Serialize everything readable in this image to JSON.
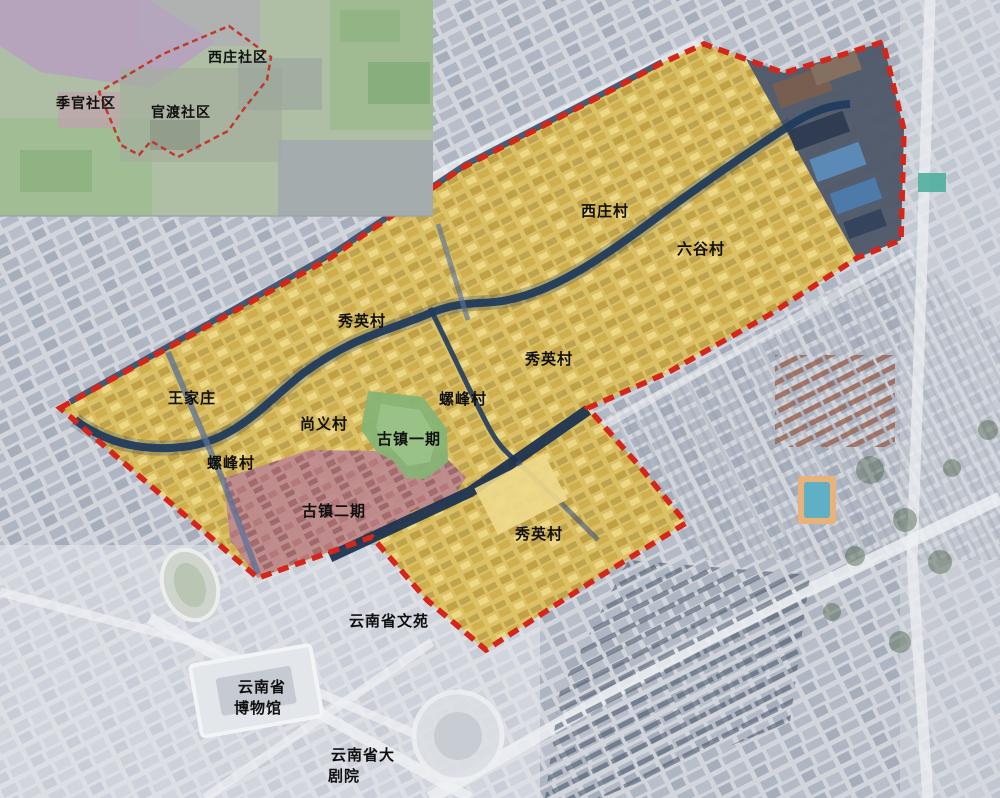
{
  "figure": {
    "type": "urban-planning-satellite-map",
    "description": "Satellite planning map with red dashed project boundary, yellow village parcels, old-town phases and a community inset map"
  },
  "colors": {
    "boundary_red": "#d5261b",
    "village_yellow": "#ddc05c",
    "phase1_green": "#86b475",
    "phase2_pink": "#bd8990",
    "river_navy": "#213b5d",
    "spike_dark": "#4e5a6e"
  },
  "inset": {
    "labels": {
      "xizhuang_community": "西庄社区",
      "jiguan_community": "季官社区",
      "guandu_community": "官渡社区"
    }
  },
  "map": {
    "labels": {
      "xizhuang_village": "西庄村",
      "liugu_village": "六谷村",
      "xiuying_village_north": "秀英村",
      "xiuying_village_center": "秀英村",
      "xiuying_village_south": "秀英村",
      "wangjiazhuang": "王家庄",
      "luofeng_village_west": "螺峰村",
      "luofeng_village_east": "螺峰村",
      "shangyi_village": "尚义村",
      "guzhen_phase1": "古镇一期",
      "guzhen_phase2": "古镇二期",
      "yunnan_wenyuan": "云南省文苑",
      "museum_line1": "云南省",
      "museum_line2": "博物馆",
      "theater_line1": "云南省大",
      "theater_line2": "剧院"
    }
  }
}
